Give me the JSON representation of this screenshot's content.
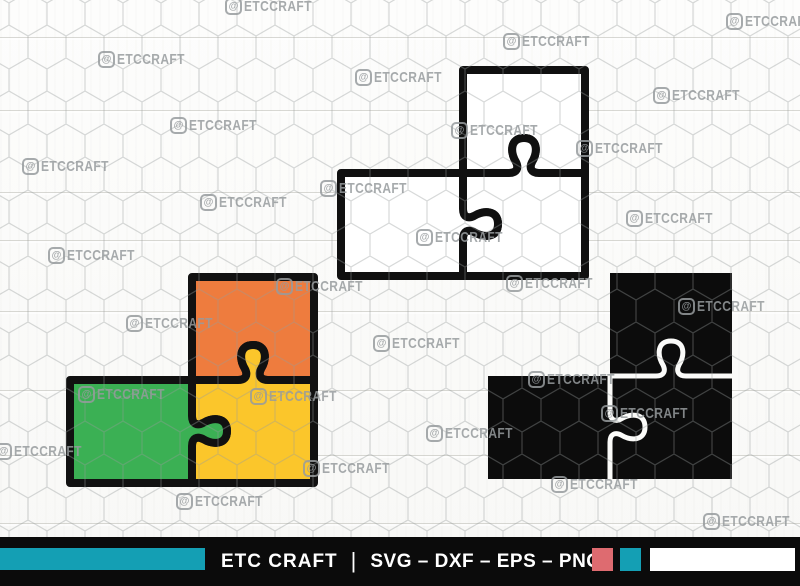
{
  "watermark": {
    "logo_glyph": "@",
    "text": "ETCCRAFT"
  },
  "watermark_positions": [
    [
      225,
      -2
    ],
    [
      98,
      51
    ],
    [
      355,
      69
    ],
    [
      170,
      117
    ],
    [
      22,
      158
    ],
    [
      320,
      180
    ],
    [
      200,
      194
    ],
    [
      48,
      247
    ],
    [
      276,
      278
    ],
    [
      726,
      13
    ],
    [
      503,
      33
    ],
    [
      653,
      87
    ],
    [
      451,
      122
    ],
    [
      576,
      140
    ],
    [
      626,
      210
    ],
    [
      416,
      229
    ],
    [
      506,
      275
    ],
    [
      126,
      315
    ],
    [
      373,
      335
    ],
    [
      78,
      386
    ],
    [
      250,
      388
    ],
    [
      -5,
      443
    ],
    [
      303,
      460
    ],
    [
      176,
      493
    ],
    [
      678,
      298
    ],
    [
      528,
      371
    ],
    [
      601,
      405
    ],
    [
      426,
      425
    ],
    [
      551,
      476
    ],
    [
      703,
      513
    ]
  ],
  "puzzles": {
    "outline": {
      "fill": "#ffffff",
      "stroke": "#101010"
    },
    "colored": {
      "stroke": "#111111",
      "top_piece": "#EE7C3E",
      "left_piece": "#3BB054",
      "bottom_piece": "#FBC62B"
    },
    "silhouette": {
      "fill": "#0c0c0c",
      "gap": "#fbfbf9"
    }
  },
  "footer": {
    "brand": "ETC CRAFT",
    "separator": "|",
    "formats": "SVG – DXF – EPS – PNG",
    "bar_color": "#0b0b0b",
    "stripe_color": "#149fb4",
    "swatch_red": "#de6b70",
    "swatch_teal": "#149fb4",
    "swatch_white": "#ffffff"
  }
}
